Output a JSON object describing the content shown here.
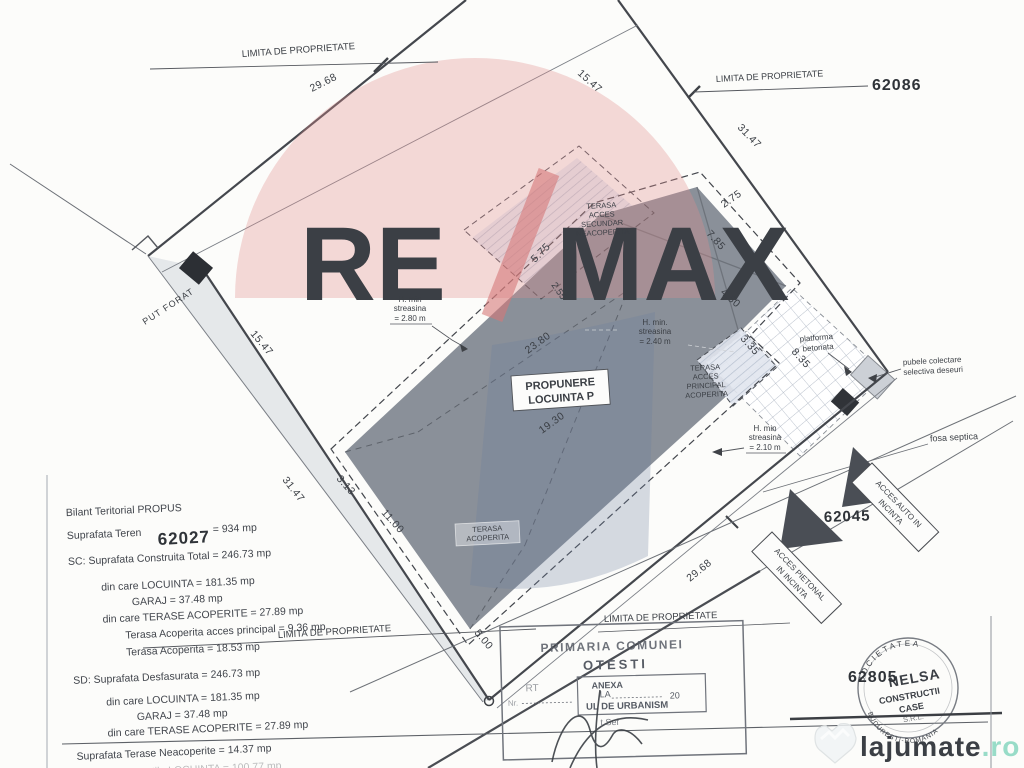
{
  "plan": {
    "proposal_line1": "PROPUNERE",
    "proposal_line2": "LOCUINTA P"
  },
  "boundary": {
    "limita_top": "LIMITA DE PROPRIETATE",
    "limita_top_right": "LIMITA DE PROPRIETATE",
    "limita_bottom_left": "LIMITA DE PROPRIETATE",
    "limita_bottom_right": "LIMITA DE PROPRIETATE"
  },
  "parcels": {
    "top_right": "62086",
    "left": "62027",
    "access": "62045",
    "bottom_right": "62805"
  },
  "dims": {
    "top_edge": "29.68",
    "top_inner": "15.47",
    "right_edge": "31.47",
    "left_edge": "31.47",
    "left_inner": "15.47",
    "bottom_edge": "29.68",
    "d275": "2.75",
    "d785": "7.85",
    "d450": "4.50",
    "d335": "3.35",
    "d835": "8.35",
    "d2380": "23.80",
    "d1930": "19.30",
    "d313": "3.13",
    "d1100": "11.00",
    "d500": "5.00",
    "d575": "5.75",
    "d255": "2.55"
  },
  "annotations": {
    "h_min_nw_1": "H. min",
    "h_min_nw_2": "streasina",
    "h_min_nw_3": "= 2.80 m",
    "h_min_mid_1": "H. min.",
    "h_min_mid_2": "streasina",
    "h_min_mid_3": "= 2.40 m",
    "h_min_se_1": "H. min",
    "h_min_se_2": "streasina",
    "h_min_se_3": "= 2.10 m",
    "terasa_sec_1": "TERASA",
    "terasa_sec_2": "ACCES",
    "terasa_sec_3": "SECUNDAR",
    "terasa_sec_4": "NEACOPERITA",
    "terasa_main_1": "TERASA",
    "terasa_main_2": "ACCES",
    "terasa_main_3": "PRINCIPAL",
    "terasa_main_4": "ACOPERITA",
    "terasa_cov_1": "TERASA",
    "terasa_cov_2": "ACOPERITA",
    "put_forat": "PUT FORAT",
    "platforma_1": "platforma",
    "platforma_2": "betonata",
    "pubele_1": "pubele colectare",
    "pubele_2": "selectiva deseuri",
    "fosa": "fosa septica",
    "acces_auto_1": "ACCES AUTO IN",
    "acces_auto_2": "INCINTA",
    "acces_pietonal_1": "ACCES PIETONAL",
    "acces_pietonal_2": "IN INCINTA"
  },
  "legend": {
    "l1": "Bilant Teritorial PROPUS",
    "l2": "Suprafata Teren",
    "l2v": "= 934 mp",
    "l3": "SC: Suprafata Construita Total  = 246.73 mp",
    "l4": "din care LOCUINTA = 181.35 mp",
    "l5": "GARAJ    = 37.48  mp",
    "l6": "din care TERASE ACOPERITE = 27.89 mp",
    "l7": "Terasa Acoperita acces principal =  9.36 mp",
    "l8": "Terasa Acoperita  = 18.53 mp",
    "l9": "SD: Suprafata Desfasurata  = 246.73 mp",
    "l10": "din care LOCUINTA = 181.35 mp",
    "l11": "GARAJ    = 37.48  mp",
    "l12": "din care TERASE ACOPERITE = 27.89 mp",
    "l13": "Suprafata Terase Neacoperite  = 14.37 mp",
    "l14": "SU: Suprafata utila LOCUINTA = 100.77 mp"
  },
  "stamps": {
    "primaria_1": "PRIMARIA COMUNEI",
    "primaria_2": "OTESTI",
    "anexa_1": "ANEXA",
    "anexa_2": "LA",
    "anexa_3": "UL DE URBANISM",
    "frag": "RT",
    "nr": "Nr.",
    "year": "20",
    "sef": "t Sef",
    "nelsa_top": "SOCIETATEA",
    "nelsa_name": "NELSA",
    "nelsa_2": "CONSTRUCTII",
    "nelsa_3": "CASE",
    "nelsa_4": "S.R.L.",
    "nelsa_bottom": "BUCURESTI-ROMANIA"
  },
  "watermarks": {
    "remax_re": "RE",
    "remax_max": "MAX",
    "lajumate": "lajumate",
    "lajumate_tld": ".ro"
  },
  "colors": {
    "accent_red": "#d98c8c",
    "balloon_blue": "#6f7ea0",
    "lajumate_teal": "#98dcc8",
    "ink": "#3d4147"
  }
}
